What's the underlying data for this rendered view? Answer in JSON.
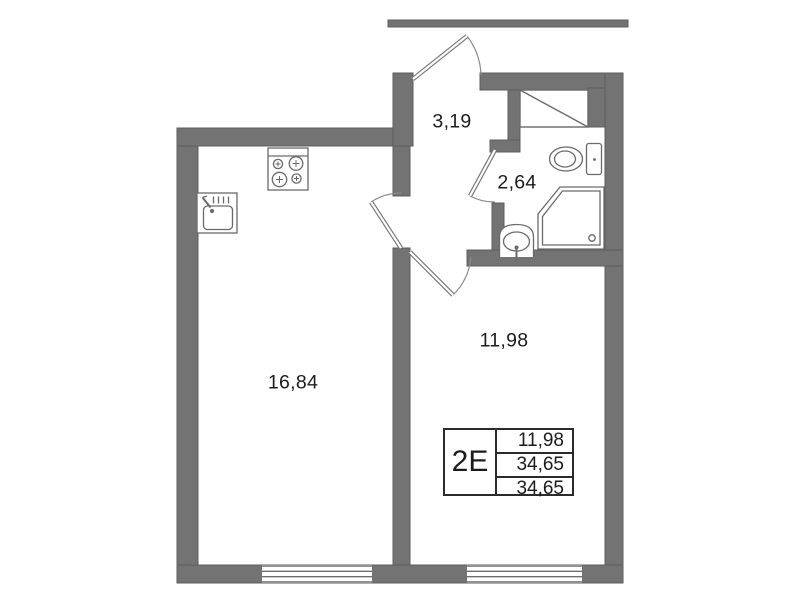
{
  "plan_title": "apartment floor plan",
  "rooms": [
    {
      "name": "hallway",
      "area": "3,19"
    },
    {
      "name": "bathroom",
      "area": "2,64"
    },
    {
      "name": "living-room",
      "area": "11,98"
    },
    {
      "name": "kitchen-living",
      "area": "16,84"
    }
  ],
  "stamp": {
    "unit_type": "2E",
    "values": [
      "11,98",
      "34,65",
      "34,65"
    ]
  },
  "fixtures": [
    "stove-icon",
    "kitchen-sink-icon",
    "toilet-icon",
    "shower-icon",
    "washbasin-icon",
    "ventilation-shaft-icon"
  ],
  "colors": {
    "wall": "#737373",
    "outline": "#6a6a6a",
    "text": "#1c1c1c",
    "background": "#ffffff"
  }
}
